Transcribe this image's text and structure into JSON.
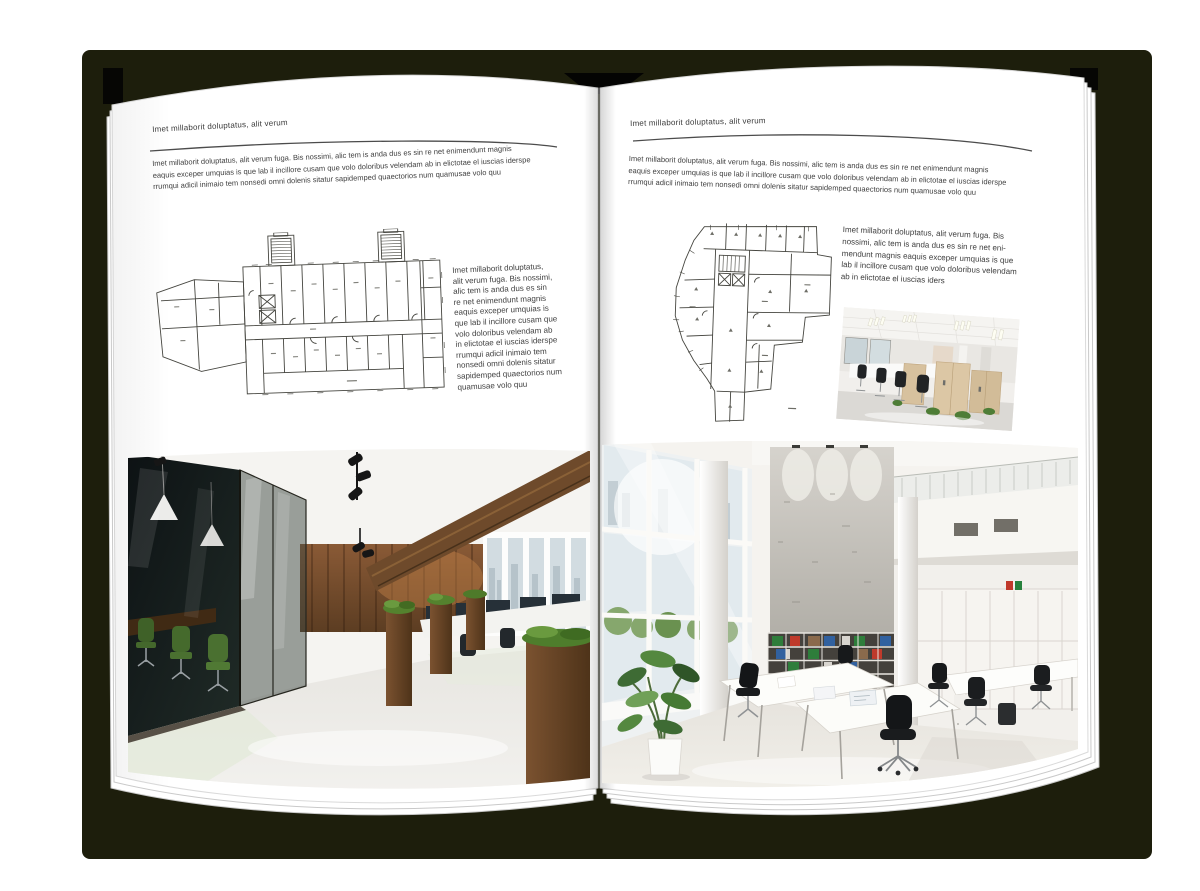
{
  "document": {
    "type_label": "open magazine spread mockup",
    "left_page": {
      "header": "Imet millaborit doluptatus, alit verum",
      "intro": "Imet millaborit doluptatus, alit verum fuga. Bis nossimi, alic tem is anda dus es sin re net enimendunt magnis\neaquis exceper umquias is que lab il incillore cusam que volo doloribus velendam ab in elictotae el iuscias iderspe\nrrumqui adicil inimaio tem nonsedi omni dolenis sitatur sapidemped quaectorios num quamusae volo quu",
      "caption": "Imet millaborit doluptatus,\nalit verum fuga. Bis nossimi,\nalic tem is anda dus es sin\nre net enimendunt magnis\neaquis exceper umquias is\nque lab il incillore cusam que\nvolo doloribus velendam ab\nin elictotae el iuscias iderspe\nrrumqui adicil inimaio tem\nnonsedi omni dolenis sitatur\nsapidemped quaectorios num\nquamusae volo quu"
    },
    "right_page": {
      "header": "Imet millaborit doluptatus, alit verum",
      "intro": "Imet millaborit doluptatus, alit verum fuga. Bis nossimi, alic tem is anda dus es sin re net enimendunt magnis\neaquis exceper umquias is que lab il incillore cusam que volo doloribus velendam ab in elictotae el iuscias iderspe\nrrumqui adicil inimaio tem nonsedi omni dolenis sitatur sapidemped quaectorios num quamusae volo quu",
      "caption": "Imet millaborit doluptatus, alit verum fuga. Bis\nnossimi, alic tem is anda dus es sin re net eni-\nmendunt magnis eaquis exceper umquias is que\nlab il incillore cusam que volo doloribus velendam\nab in elictotae el iuscias iders"
    },
    "colors": {
      "cover": "#1d1e0c",
      "page": "#ffffff",
      "text": "#404040",
      "rule": "#4c4c4c"
    }
  }
}
